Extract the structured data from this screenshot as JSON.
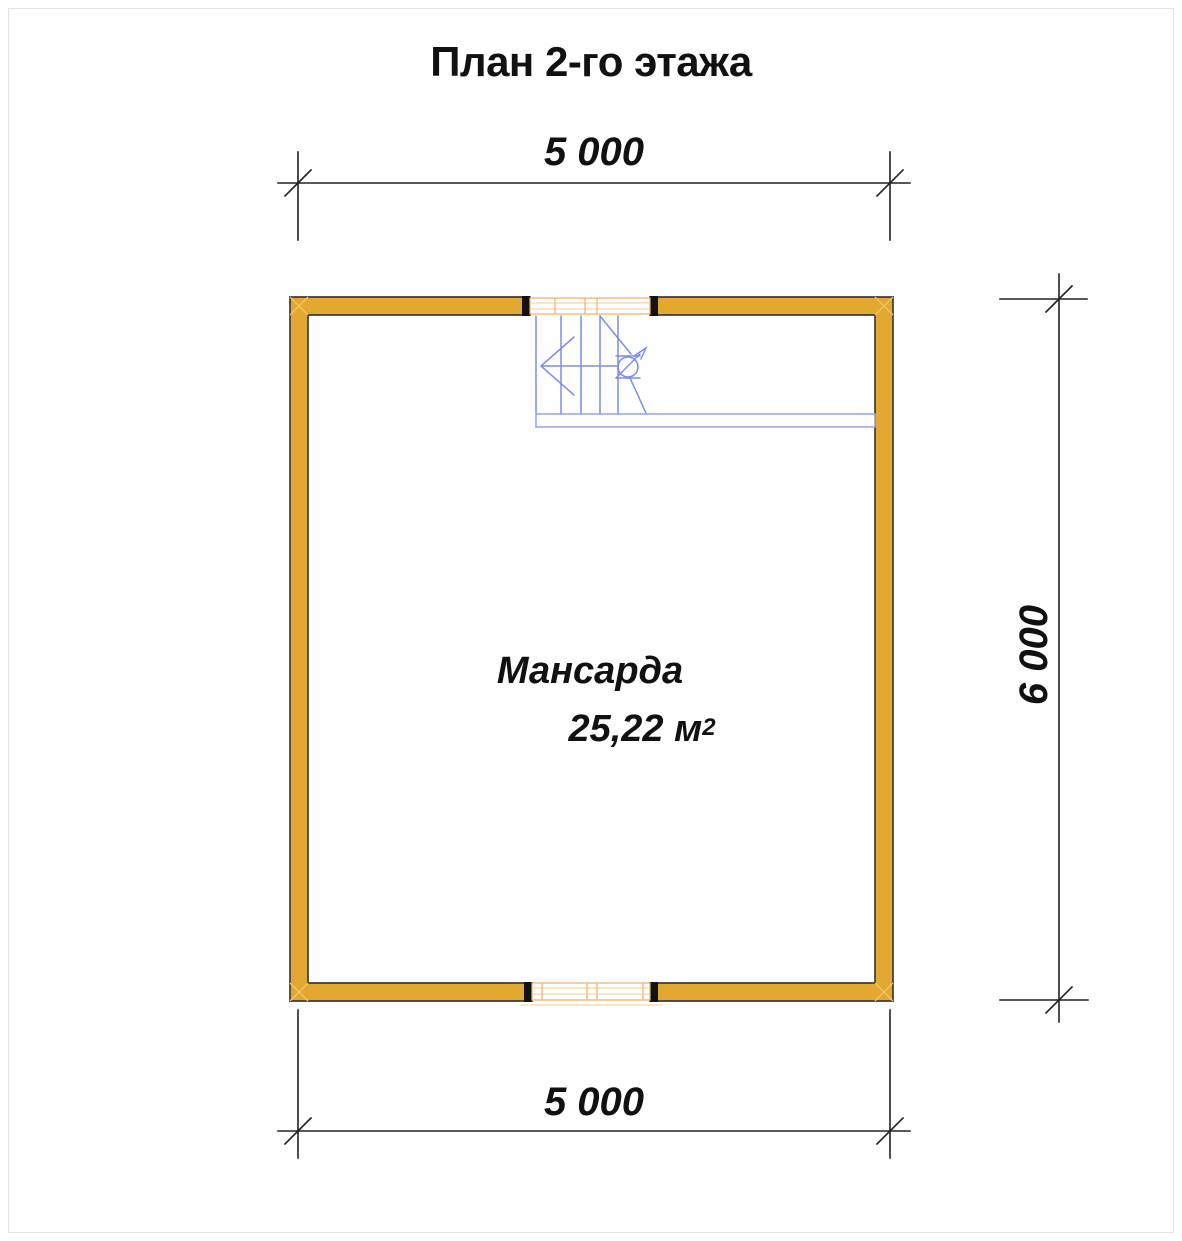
{
  "title": "План 2-го этажа",
  "plan": {
    "room": {
      "name": "Мансарда",
      "area": "25,22 м",
      "area_superscript": "2"
    },
    "dimensions": {
      "top": "5 000",
      "bottom": "5 000",
      "right": "6 000"
    }
  },
  "colors": {
    "wall_fill": "#e2a82f",
    "wall_outline": "#3c3c3c",
    "cap_color": "#121212",
    "corner_line": "#f0c468",
    "window_line": "#f2ae62",
    "window_line_light": "#f8d6a8",
    "stair_line": "#7d8cea",
    "rail_line": "#93a0ee",
    "dim_line": "#222222",
    "text_color": "#111111"
  }
}
